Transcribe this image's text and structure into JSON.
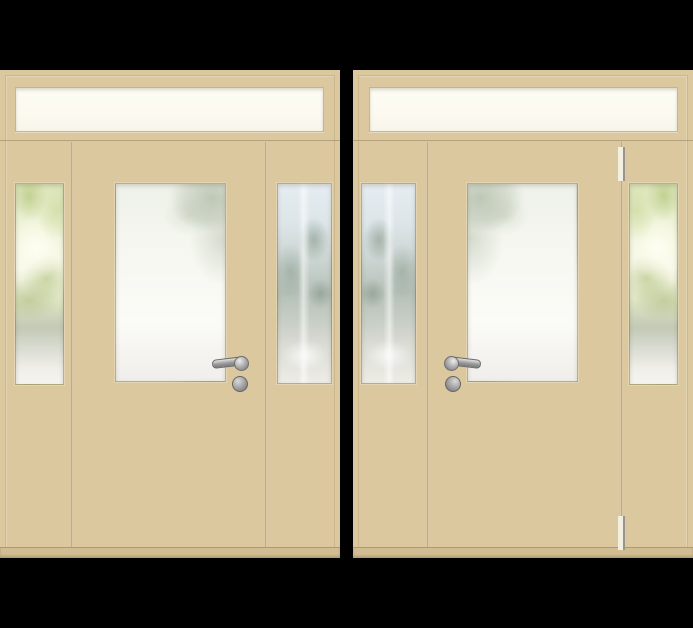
{
  "scene": {
    "description": "Two beige exterior door units with transom window and two glazed sidelights, rendered on a black background",
    "background": "#000000"
  },
  "palette": {
    "background": "#000000",
    "door_beige": "#dcc89e",
    "door_beige_dark": "#d2bd92",
    "glass_white": "#fcfaf0",
    "metal_gray": "#9e9e9e",
    "hinge_cream": "#f3efe2"
  },
  "units": [
    {
      "id": "left-door-unit",
      "transom": "white-glass",
      "left_sidelight": "foliage-glass",
      "right_sidelight": "street-glass",
      "door_glass": "frosted-foliage",
      "handle_side": "right-of-door",
      "lever_direction": "left",
      "hinges_visible": false
    },
    {
      "id": "right-door-unit",
      "transom": "white-glass",
      "left_sidelight": "street-glass",
      "right_sidelight": "foliage-glass",
      "door_glass": "frosted-foliage",
      "handle_side": "left-of-door",
      "lever_direction": "right",
      "hinges_visible": true
    }
  ]
}
